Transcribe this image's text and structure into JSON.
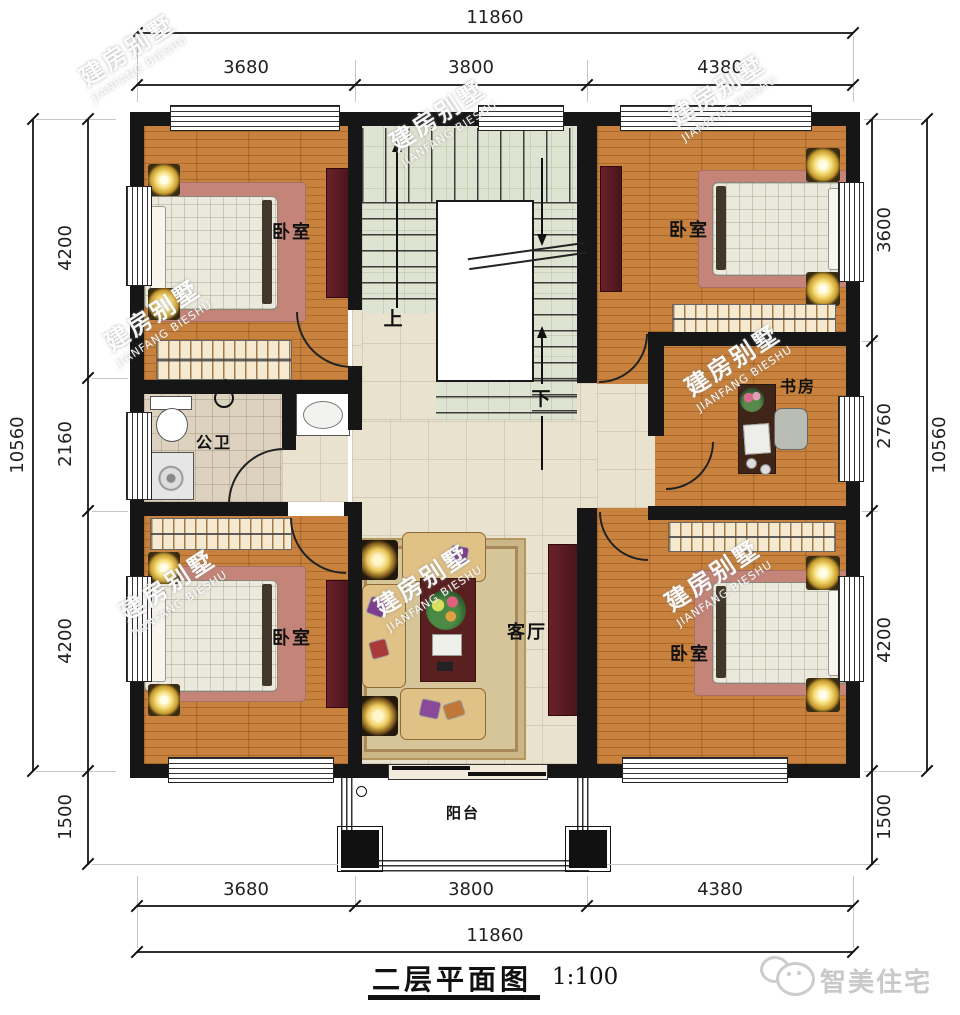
{
  "title": {
    "name": "二层平面图",
    "scale": "1:100"
  },
  "brand": {
    "logo_text": "智美住宅"
  },
  "watermark": {
    "cn": "建房别墅",
    "en": "JIANFANG BIESHU"
  },
  "dims": {
    "top": {
      "total": "11860",
      "segments": [
        "3680",
        "3800",
        "4380"
      ]
    },
    "bottom": {
      "total": "11860",
      "segments": [
        "3680",
        "3800",
        "4380"
      ]
    },
    "left": {
      "total": "10560",
      "segments": [
        "4200",
        "2160",
        "4200",
        "1500"
      ]
    },
    "right": {
      "total": "10560",
      "segments": [
        "3600",
        "2760",
        "4200",
        "1500"
      ]
    }
  },
  "rooms": {
    "bedroom": "卧室",
    "bathroom": "公卫",
    "study": "书房",
    "living": "客厅",
    "balcony": "阳台",
    "up": "上",
    "down": "下"
  }
}
